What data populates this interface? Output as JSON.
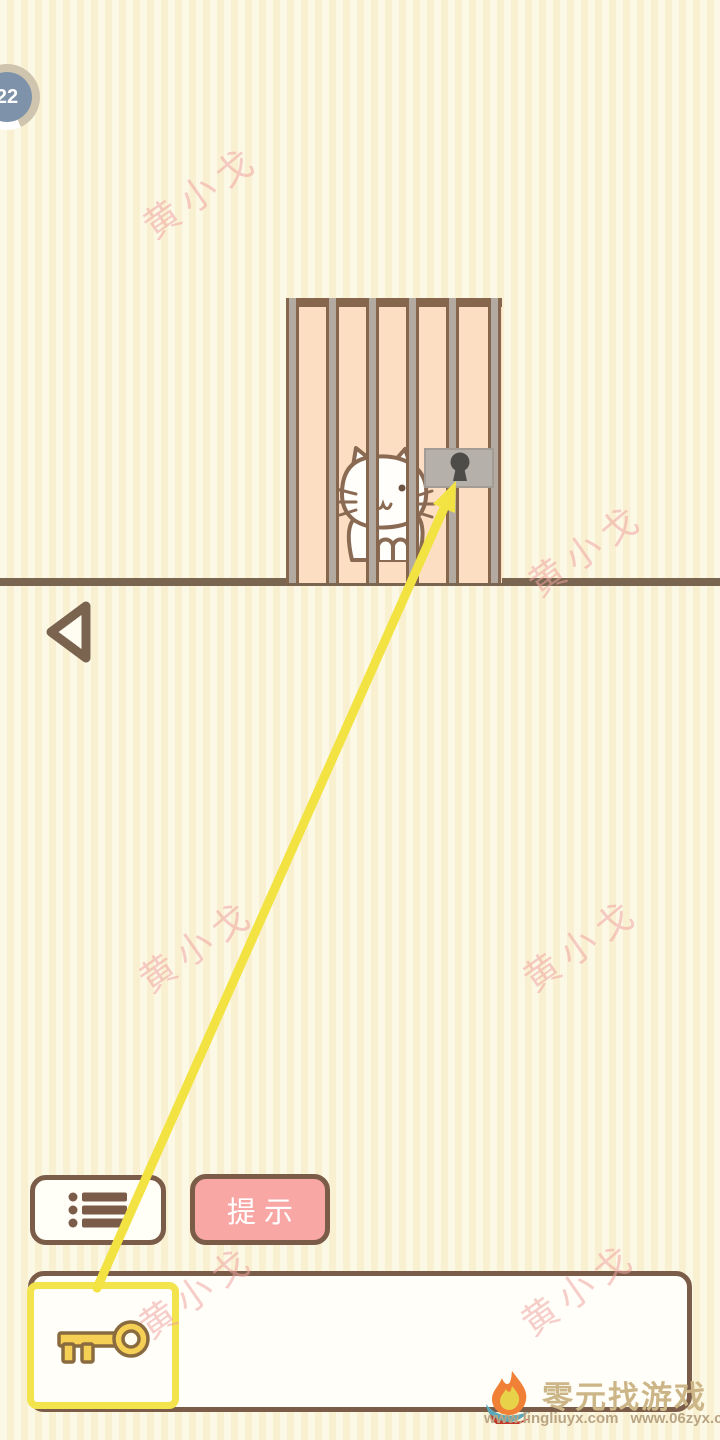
{
  "hud": {
    "level": "22"
  },
  "toolbar": {
    "hint_label": "提示"
  },
  "inventory": {
    "slots": [
      {
        "item": "key",
        "selected": true,
        "icon": "key-icon"
      }
    ]
  },
  "scene": {
    "cage": "wooden cage with vertical bars",
    "cat": "white cat behind bars",
    "lock": "gray padlock plate with keyhole",
    "hint_arrow": "yellow arrow from key item to lock keyhole"
  },
  "watermark": {
    "text": "黄小戈"
  },
  "footer": {
    "site_name": "零元找游戏",
    "urls": [
      "www.lingliuyx.com",
      "www.06zyx.com"
    ]
  },
  "icons": {
    "menu": "list-icon",
    "back": "back-arrow-icon",
    "key": "key-icon",
    "lock": "keyhole-icon",
    "logo": "flame-logo-icon"
  },
  "colors": {
    "background": "#fbf3d7",
    "cage_fill": "#fcdfc2",
    "bar_brown": "#87664e",
    "bar_gray": "#b3aaa2",
    "accent_yellow": "#f2e342",
    "hint_pink": "#f8a7a5",
    "ui_brown": "#7b5c49",
    "badge_blue": "#7e93a9",
    "watermark_pink": "#eea4a0"
  }
}
